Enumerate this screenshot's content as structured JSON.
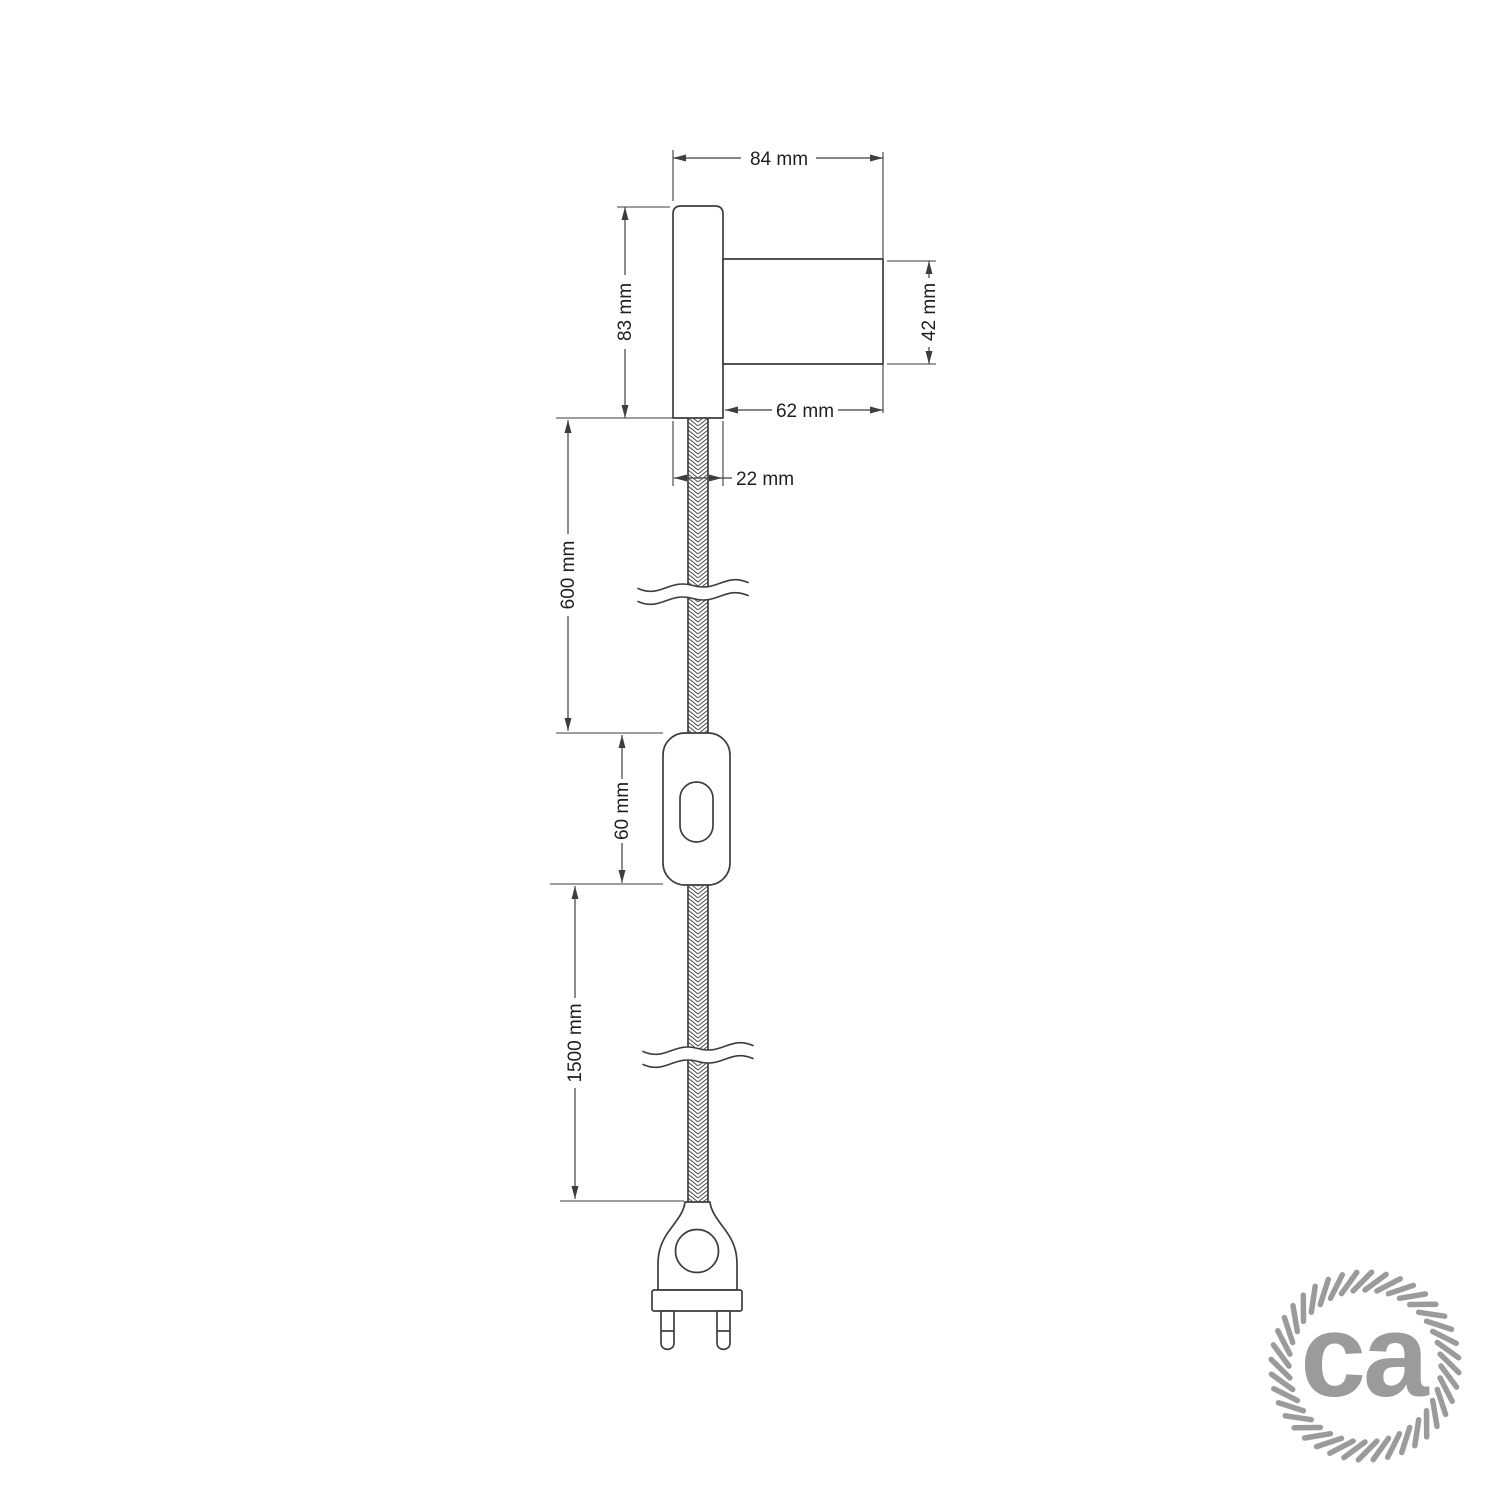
{
  "drawing": {
    "kind": "dimensioned technical drawing of a wall lamp with braided cable, inline switch and two-pin plug",
    "dimensions": {
      "fixture_width": "84 mm",
      "base_height": "83 mm",
      "socket_diameter": "42 mm",
      "socket_length": "62 mm",
      "base_depth": "22 mm",
      "cable_upper_length": "600 mm",
      "switch_length": "60 mm",
      "cable_lower_length": "1500 mm"
    },
    "colors": {
      "line": "#3d3d3d",
      "label_text": "#1f1f1f",
      "background": "#ffffff"
    }
  },
  "logo": {
    "text": "ca",
    "color": "#9b9b9b"
  }
}
